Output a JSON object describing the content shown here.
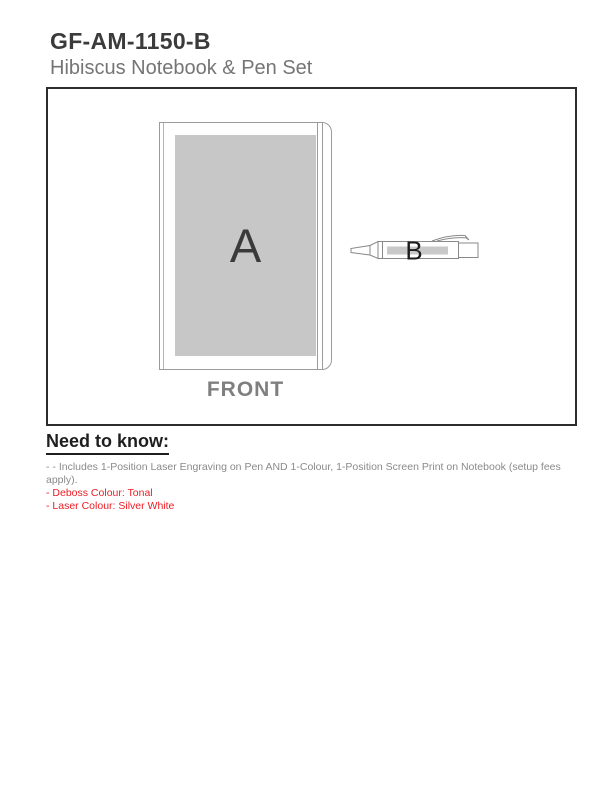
{
  "header": {
    "product_code": "GF-AM-1150-B",
    "product_name": "Hibiscus Notebook & Pen Set"
  },
  "diagram": {
    "notebook_imprint_letter": "A",
    "pen_imprint_letter": "B",
    "view_label": "FRONT"
  },
  "need_to_know": {
    "heading": "Need to know:",
    "notes": [
      {
        "text": "- - Includes 1-Position Laser Engraving on Pen AND 1-Colour, 1-Position Screen Print on Notebook (setup fees apply).",
        "style": "gray"
      },
      {
        "text": "- Deboss Colour: Tonal",
        "style": "red"
      },
      {
        "text": "- Laser Colour: Silver White",
        "style": "red"
      }
    ]
  },
  "colors": {
    "red_text": "#ed1c24",
    "gray_text": "#8a8a8a",
    "title_text": "#3b3b3b",
    "subtitle_text": "#757575",
    "imprint_area_gray": "#c7c7c8",
    "frame_border": "#2d2d2d",
    "outline_gray": "#9b9b9b"
  }
}
